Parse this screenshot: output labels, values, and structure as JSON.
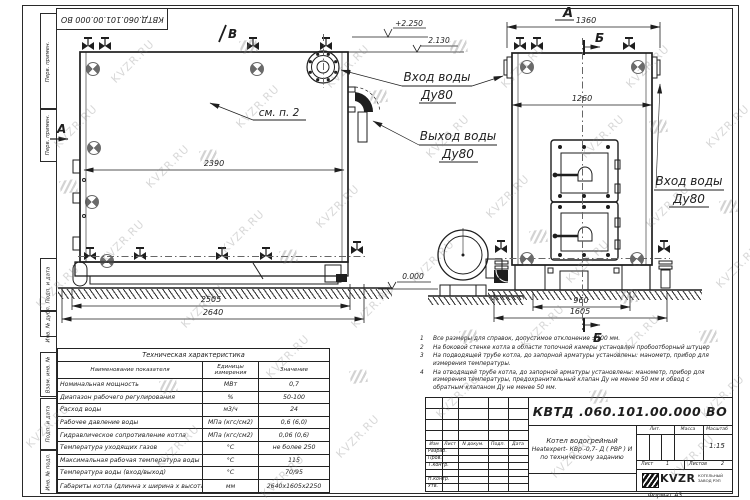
{
  "doc": {
    "number_top": "КВТД.060.101.00.000 ВО",
    "number_main": "КВТД .060.101.00.000  ВО",
    "format_label": "Формат  А3"
  },
  "watermark": {
    "text": "KVZR.RU"
  },
  "frame": {
    "stamps": [
      "Перв. примен.",
      "Перв. примен.",
      "Подп. и дата",
      "Инв. № дубл.",
      "Взам. инв. №",
      "Подп. и дата",
      "Инв. № подл."
    ]
  },
  "drawing": {
    "markers": {
      "a": "А",
      "b": "Б",
      "v": "В"
    },
    "dims": {
      "side_inner": "2390",
      "side_len": "2505",
      "side_full": "2640",
      "front_width": "1360",
      "front_inner": "1260",
      "front_base": "960",
      "front_full": "1605"
    },
    "elevations": {
      "top": "+2.250",
      "inlet": "2.130",
      "zero": "0.000"
    },
    "see_note": "см. п. 2",
    "labels": {
      "inlet_top": {
        "l1": "Вход воды",
        "l2": "Ду80"
      },
      "outlet": {
        "l1": "Выход воды",
        "l2": "Ду80"
      },
      "inlet_side": {
        "l1": "Вход воды",
        "l2": "Ду80"
      }
    }
  },
  "tech_table": {
    "title": "Техническая характеристика",
    "headers": {
      "name": "Наименование показателя",
      "units": "Единицы измерения",
      "value": "Значение"
    },
    "rows": [
      {
        "name": "Номинальная мощность",
        "units": "МВт",
        "value": "0,7"
      },
      {
        "name": "Диапазон рабочего регулирования",
        "units": "%",
        "value": "50-100"
      },
      {
        "name": "Расход воды",
        "units": "м3/ч",
        "value": "24"
      },
      {
        "name": "Рабочее давление воды",
        "units": "МПа (кгс/см2)",
        "value": "0,6 (6,0)"
      },
      {
        "name": "Гидравлическое сопротивление котла",
        "units": "МПа (кгс/см2)",
        "value": "0,06 (0,6)"
      },
      {
        "name": "Температура уходящих газов",
        "units": "°С",
        "value": "не более 250"
      },
      {
        "name": "Максимальная рабочая температура воды",
        "units": "°С",
        "value": "115"
      },
      {
        "name": "Температура воды (вход/выход)",
        "units": "°С",
        "value": "70/95"
      },
      {
        "name": "Габариты котла (длинна х ширина х высота)",
        "units": "мм",
        "value": "2640х1605х2250"
      }
    ]
  },
  "notes": [
    {
      "num": "1",
      "text": "Все размеры для справок, допустимое отклонение ±100 мм."
    },
    {
      "num": "2",
      "text": "На боковой стенке котла в области топочной камеры установлен пробоотборный штуцер"
    },
    {
      "num": "3",
      "text": "На подводящей трубе котла, до запорной арматуры установлены: манометр, прибор для измерения температуры."
    },
    {
      "num": "4",
      "text": "На отводящей трубе котла, до запорной арматуры установлены: манометр, прибор для измерения температуры, предохранительный клапан Ду не менее 50 мм и обвод с обратным клапаном Ду не менее 50 мм."
    }
  ],
  "title_block": {
    "cols": [
      "Изм",
      "Лист",
      "N докум.",
      "Подп.",
      "Дата"
    ],
    "rows": [
      "Разраб.",
      "Пров.",
      "Т.контр.",
      "Н.контр.",
      "Утв."
    ],
    "product": [
      "Котел водогрейный",
      "Heatexpert- КВр -0,7- Д ( РВР ) И",
      "по техническому заданию"
    ],
    "lit_label": "Лит.",
    "mass_label": "Масса",
    "scale_label": "Масштаб",
    "scale": "1:15",
    "sheet_label": "Лист",
    "sheet": "1",
    "sheets_label": "Листов",
    "sheets": "2",
    "company": "KVZR",
    "company_line1": "КОТЕЛЬНЫЙ",
    "company_line2": "ЗАВОД РЭП"
  }
}
